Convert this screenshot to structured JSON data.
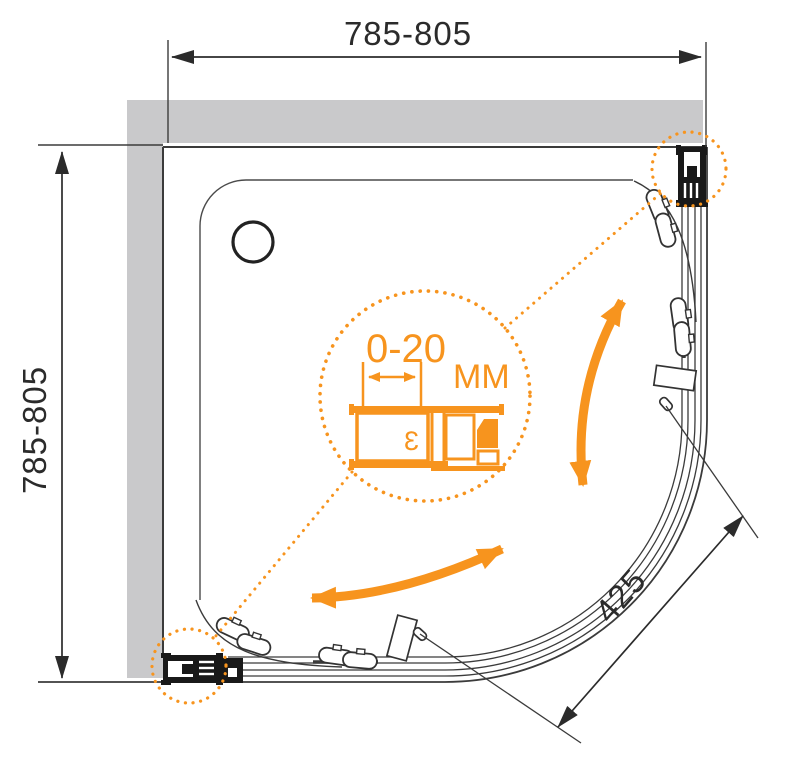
{
  "drawing": {
    "type": "shower-enclosure-plan-view",
    "colors": {
      "accent_orange": "#F7941E",
      "wall_gray": "#C9C9CB",
      "line_dark": "#3B3B3B",
      "profile_black": "#191919"
    },
    "dimensions": {
      "width": {
        "label": "785-805"
      },
      "depth": {
        "label": "785-805"
      },
      "door_opening": {
        "label": "425"
      },
      "adjustment": {
        "range_label": "0-20",
        "unit_label": "MM"
      }
    }
  }
}
